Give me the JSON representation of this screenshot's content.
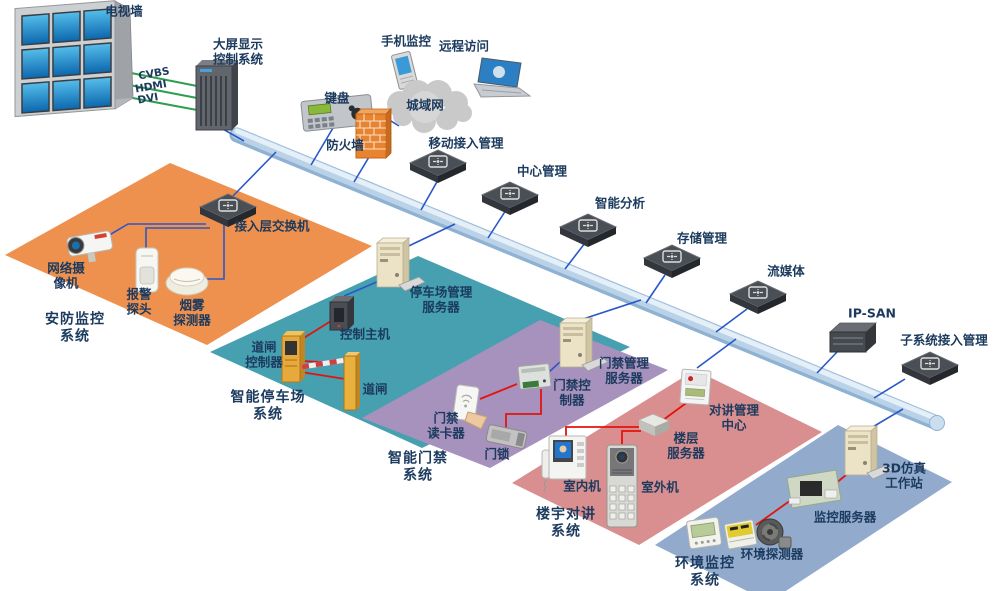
{
  "diagram": {
    "type": "network-topology",
    "labels": {
      "tv_wall": "电视墙",
      "cvbs": "CVBS",
      "hdmi": "HDMI",
      "dvi": "DVI",
      "big_screen": "大屏显示\n控制系统",
      "phone_monitor": "手机监控",
      "remote_access": "远程访问",
      "keyboard": "键盘",
      "man": "城域网",
      "firewall": "防火墙",
      "mobile_access": "移动接入管理",
      "center_mgmt": "中心管理",
      "intelligent_analysis": "智能分析",
      "storage_mgmt": "存储管理",
      "streaming": "流媒体",
      "ipsan": "IP-SAN",
      "subsystem_access": "子系统接入管理",
      "access_switch": "接入层交换机",
      "network_camera": "网络摄\n像机",
      "alarm_probe": "报警\n探头",
      "smoke_detector": "烟雾\n探测器",
      "security_system": "安防监控\n系统",
      "parking_server": "停车场管理\n服务器",
      "control_host": "控制主机",
      "gate_controller": "道闸\n控制器",
      "gate": "道闸",
      "parking_system": "智能停车场\n系统",
      "access_server": "门禁管理\n服务器",
      "access_controller": "门禁控\n制器",
      "card_reader": "门禁\n读卡器",
      "door_lock": "门锁",
      "access_system": "智能门禁\n系统",
      "indoor_unit": "室内机",
      "outdoor_unit": "室外机",
      "floor_server": "楼层\n服务器",
      "intercom_center": "对讲管理\n中心",
      "building_intercom": "楼宇对讲\n系统",
      "workstation_3d": "3D仿真\n工作站",
      "monitor_server": "监控服务器",
      "env_detector": "环境探测器",
      "env_system": "环境监控\n系统"
    },
    "colors": {
      "region_security": "#EF914E",
      "region_parking": "#47A0B0",
      "region_access": "#A791BD",
      "region_intercom": "#D98F8F",
      "region_environment": "#92ABCD",
      "backbone": "#B9D2E8",
      "line_network": "#2857C8",
      "line_signal": "#E2140E",
      "line_video": "#2F9E4F",
      "label_text": "#1B3A5E"
    }
  }
}
